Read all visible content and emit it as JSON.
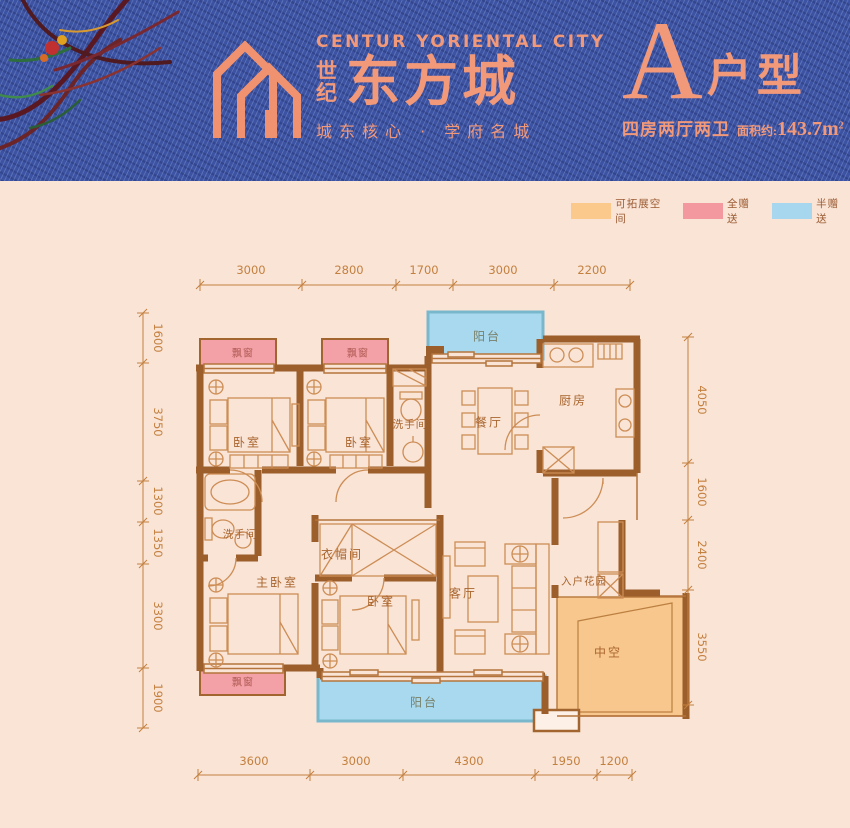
{
  "header": {
    "brand_en": "CENTUR YORIENTAL CITY",
    "brand_prefix": "世纪",
    "brand_cn": "东方城",
    "slogan": "城东核心 · 学府名城",
    "unit_letter": "A",
    "unit_suffix": "户型",
    "unit_spec": "四房两厅两卫",
    "area_label": "面积约:",
    "area_value": "143.7m",
    "area_sup": "2",
    "colors": {
      "denim": "#3c52a2",
      "accent": "#f2997a"
    }
  },
  "legend": {
    "items": [
      {
        "label": "可拓展空间",
        "color": "#fbc98b"
      },
      {
        "label": "全赠送",
        "color": "#f2989e"
      },
      {
        "label": "半赠送",
        "color": "#a6d7ef"
      }
    ]
  },
  "plan": {
    "rooms": {
      "balcony_top": "阳台",
      "kitchen": "厨房",
      "dining": "餐厅",
      "bath_upper": "洗手间",
      "bedroom_a": "卧室",
      "bedroom_b": "卧室",
      "bay_a": "飘窗",
      "bay_b": "飘窗",
      "bath_lower": "洗手间",
      "master_bedroom": "主卧室",
      "cloakroom": "衣帽间",
      "bedroom_c": "卧室",
      "living": "客厅",
      "entry_garden": "入户花园",
      "void_space": "中空",
      "bay_c": "飘窗",
      "balcony_bottom": "阳台"
    },
    "dims_top": [
      "3000",
      "2800",
      "1700",
      "3000",
      "2200"
    ],
    "dims_bottom": [
      "3600",
      "3000",
      "4300",
      "1950",
      "1200"
    ],
    "dims_left": [
      "1600",
      "3750",
      "1300",
      "1350",
      "3300",
      "1900"
    ],
    "dims_right": [
      "4050",
      "1600",
      "2400",
      "3550"
    ],
    "colors": {
      "wall": "#9c5e2a",
      "line": "#c8895a",
      "dimension": "#c4803f",
      "bay_window_fill": "#f3a0a6",
      "balcony_fill": "#a8d9ef",
      "void_fill": "#f7c78d"
    }
  }
}
